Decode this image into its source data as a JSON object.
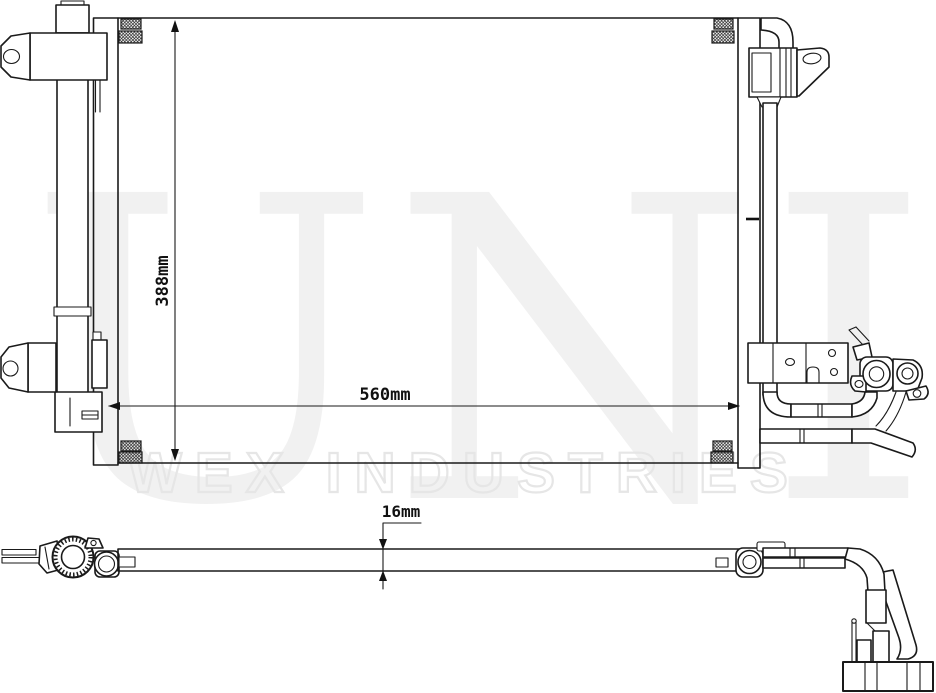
{
  "watermark": {
    "brand_text": "UNIO",
    "industries_text": "WEX INDUSTRIES",
    "brand_color": "#f1f1f1",
    "industries_outline_color": "#e6e6e6"
  },
  "dimensions": {
    "core_height": "388mm",
    "core_width": "560mm",
    "core_thickness": "16mm"
  },
  "drawing": {
    "ink_color": "#1a1a1a",
    "background_color": "#ffffff"
  }
}
